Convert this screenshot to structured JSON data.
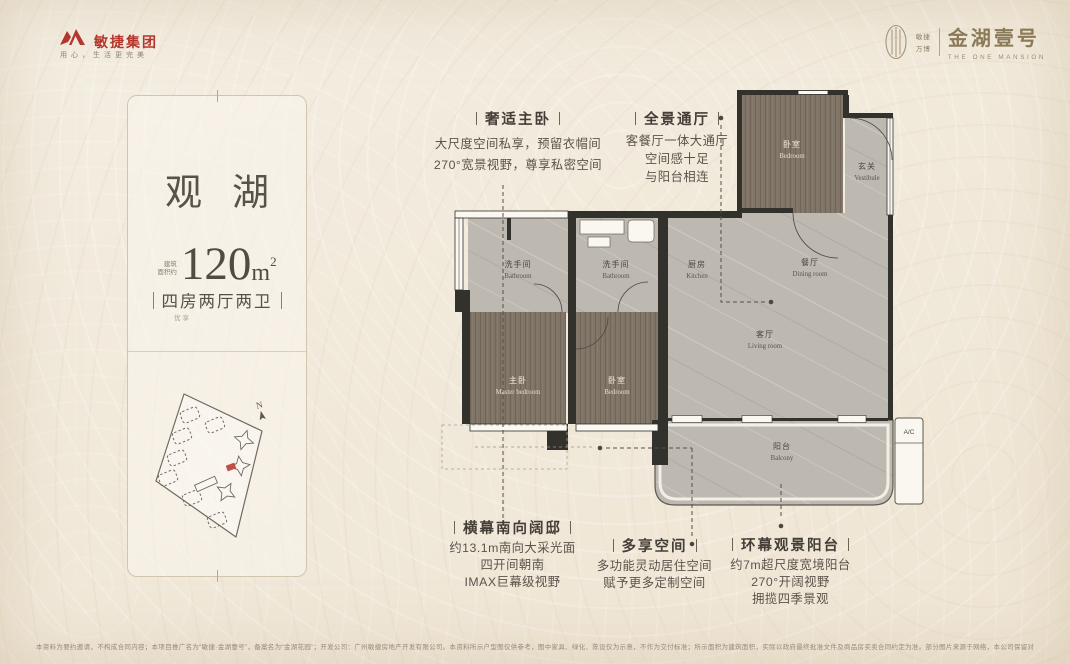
{
  "header": {
    "brand": {
      "logo_icon": "agile-swoosh-icon",
      "name": "敏捷集团",
      "slogan": "用心，生活更完美"
    },
    "project": {
      "logo_icon": "mansion-emblem-icon",
      "tag_line1": "敏捷",
      "tag_line2": "万博",
      "name": "金湖壹号",
      "name_en": "THE ONE MANSION"
    }
  },
  "card": {
    "title": "观湖",
    "area": {
      "prefix_line1": "建筑",
      "prefix_line2": "面积约",
      "value": "120",
      "unit": "m",
      "sup": "2"
    },
    "layout_tag": "四房两厅两卫",
    "layout_sub": "优享",
    "siteplan": {
      "compass": "N",
      "marker_color": "#c04f45"
    }
  },
  "floorplan": {
    "rooms": [
      {
        "cn": "卧室",
        "en": "Bedroom"
      },
      {
        "cn": "玄关",
        "en": "Vestibule"
      },
      {
        "cn": "洗手间",
        "en": "Bathroom"
      },
      {
        "cn": "洗手间",
        "en": "Bathroom"
      },
      {
        "cn": "厨房",
        "en": "Kitchen"
      },
      {
        "cn": "餐厅",
        "en": "Dining room"
      },
      {
        "cn": "客厅",
        "en": "Living room"
      },
      {
        "cn": "主卧",
        "en": "Master bedroom"
      },
      {
        "cn": "卧室",
        "en": "Bedroom"
      },
      {
        "cn": "阳台",
        "en": "Balcony"
      }
    ],
    "ac_label": "A/C",
    "colors": {
      "wall": "#33312c",
      "wood_floor": "#7d7264",
      "tile_floor": "#bcb8b0"
    }
  },
  "annotations": [
    {
      "title": "奢适主卧",
      "lines": [
        "大尺度空间私享，预留衣帽间",
        "270°宽景视野，尊享私密空间"
      ]
    },
    {
      "title": "全景通厅",
      "lines": [
        "客餐厅一体大通厅",
        "空间感十足",
        "与阳台相连"
      ]
    },
    {
      "title": "横幕南向阔邸",
      "lines": [
        "约13.1m南向大采光面",
        "四开间朝南",
        "IMAX巨幕级视野"
      ]
    },
    {
      "title": "多享空间",
      "lines": [
        "多功能灵动居住空间",
        "赋予更多定制空间"
      ]
    },
    {
      "title": "环幕观景阳台",
      "lines": [
        "约7m超尺度宽境阳台",
        "270°开阔视野",
        "拥揽四季景观"
      ]
    }
  ],
  "footer": {
    "disclaimer": "本资料为要约邀请，不构成合同内容；本项目推广名为“敏捷·金湖壹号”，备案名为“金湖花园”；开发公司：广州敏捷房地产开发有限公司。本资料所示户型图仅供参考，图中家具、绿化、陈设仅为示意，不作为交付标准；所示面积为建筑面积，实际以政府最终批准文件及商品房买卖合同约定为准。部分图片来源于网络，本公司保留对宣传资料修改的权利，敬请留意最新资料。具体详情请详询销售中心。"
  }
}
